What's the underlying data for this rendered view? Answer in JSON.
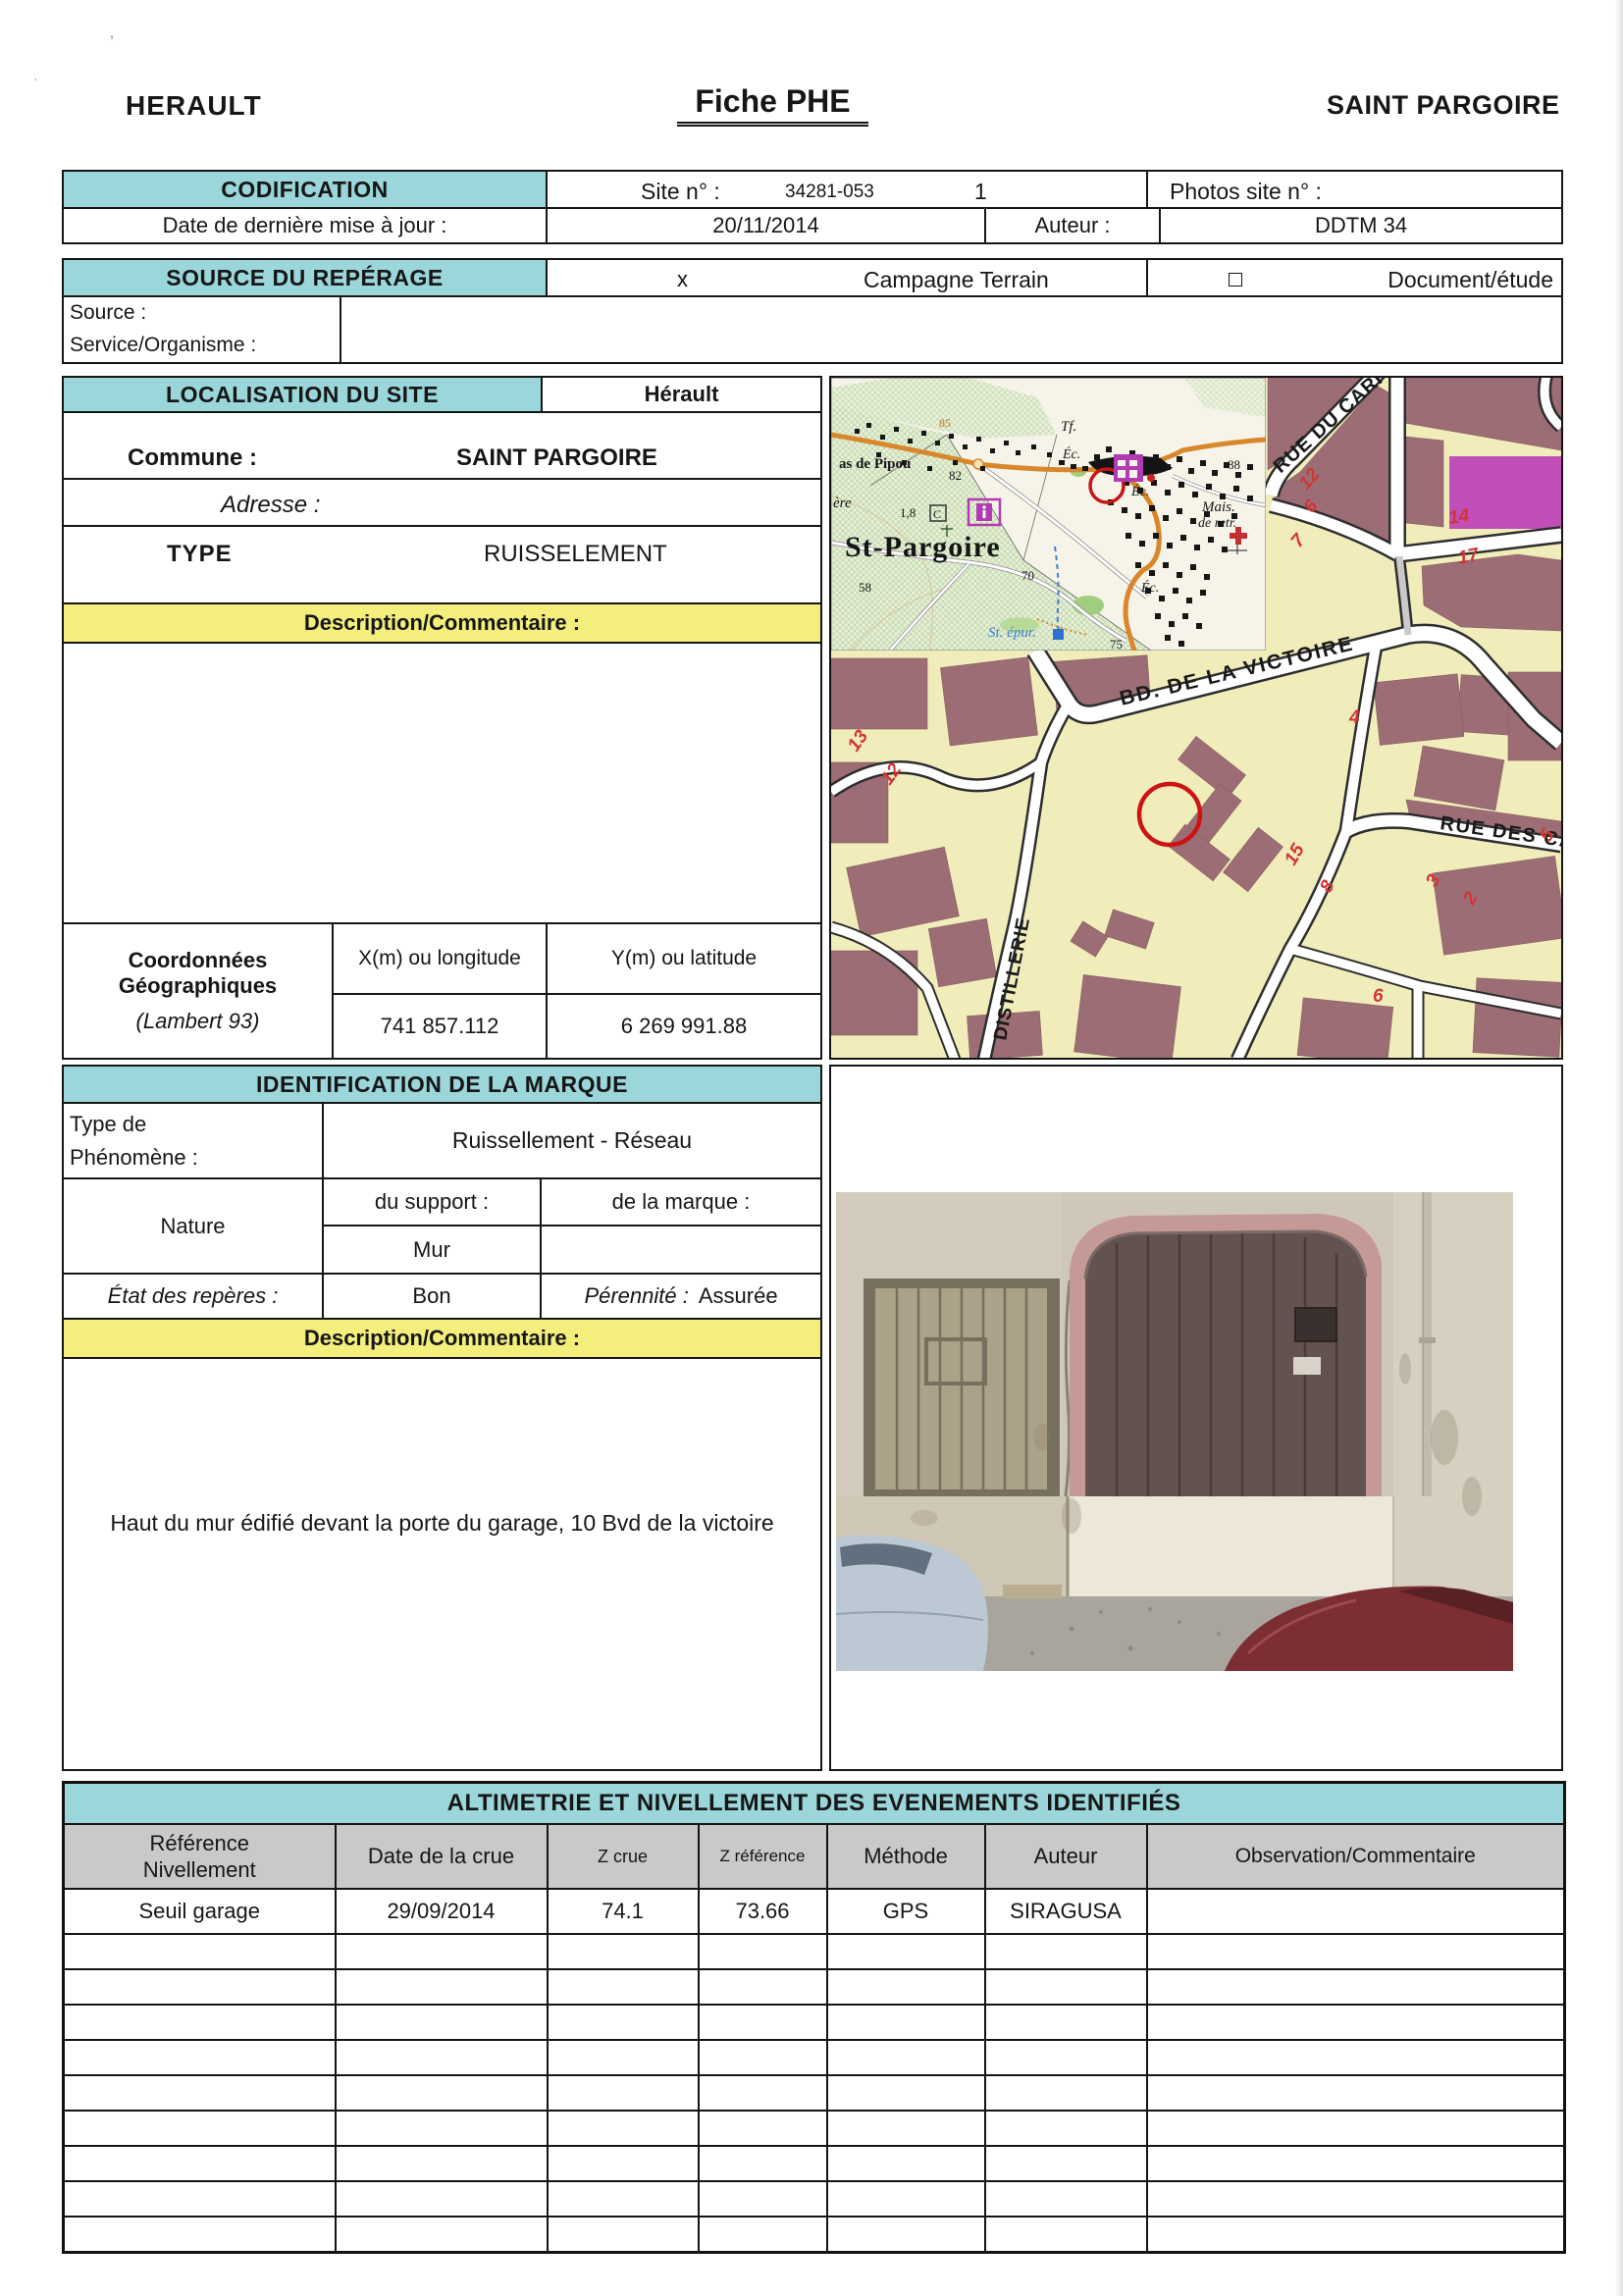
{
  "header": {
    "left": "HERAULT",
    "center": "Fiche PHE",
    "right": "SAINT PARGOIRE"
  },
  "codification": {
    "title": "CODIFICATION",
    "site_label": "Site n° :",
    "site_value": "34281-053",
    "site_index": "1",
    "photos_label": "Photos site n° :",
    "date_label": "Date de dernière mise à jour :",
    "date_value": "20/11/2014",
    "auteur_label": "Auteur :",
    "auteur_value": "DDTM 34"
  },
  "source": {
    "title": "SOURCE DU REPÉRAGE",
    "campagne_mark": "x",
    "campagne_label": "Campagne Terrain",
    "document_label": "Document/étude",
    "source_label": "Source :",
    "service_label": "Service/Organisme :"
  },
  "localisation": {
    "title": "LOCALISATION DU SITE",
    "departement": "Hérault",
    "commune_label": "Commune :",
    "commune_value": "SAINT PARGOIRE",
    "adresse_label": "Adresse :",
    "type_label": "TYPE",
    "type_value": "RUISSELEMENT",
    "description_label": "Description/Commentaire :",
    "coords": {
      "line1": "Coordonnées",
      "line2": "Géographiques",
      "subtitle": "(Lambert 93)",
      "x_label": "X(m) ou longitude",
      "y_label": "Y(m) ou latitude",
      "x_value": "741 857.112",
      "y_value": "6 269 991.88"
    }
  },
  "identification": {
    "title": "IDENTIFICATION DE LA MARQUE",
    "phenomene_label1": "Type de",
    "phenomene_label2": "Phénomène :",
    "phenomene_value": "Ruissellement - Réseau",
    "nature_label": "Nature",
    "support_label": "du support :",
    "marque_label": "de la marque :",
    "support_value": "Mur",
    "etat_label": "État des repères :",
    "etat_value": "Bon",
    "perennite_label": "Pérennité :",
    "perennite_value": "Assurée",
    "description_label": "Description/Commentaire :",
    "description_value": "Haut du mur édifié devant la porte du garage, 10 Bvd de la victoire"
  },
  "altimetrie": {
    "title": "ALTIMETRIE ET NIVELLEMENT DES EVENEMENTS IDENTIFIÉS",
    "columns": [
      "Référence\nNivellement",
      "Date de la crue",
      "Z crue",
      "Z référence",
      "Méthode",
      "Auteur",
      "Observation/Commentaire"
    ],
    "row": [
      "Seuil garage",
      "29/09/2014",
      "74.1",
      "73.66",
      "GPS",
      "SIRAGUSA"
    ]
  },
  "map": {
    "inset": {
      "town": "St-Pargoire",
      "pipou": "as de Pipou",
      "ere": "ère",
      "tf": "Tf.",
      "ec": "Éc.",
      "mais": "Mais.",
      "retr": "de retr.",
      "epur": "St. épur.",
      "n85": "85",
      "n82": "82",
      "n88": "88",
      "n70": "70",
      "n58": "58",
      "n75": "75",
      "n18": "1,8",
      "c": "C"
    },
    "streets": {
      "carri": "RUE DU CARRI",
      "victoire": "BD. DE LA VICTOIRE",
      "des_ca": "RUE DES CA",
      "distillerie": "DISTILLERIE"
    },
    "numbers": {
      "n12a": "12",
      "n6a": "6",
      "n7": "7",
      "n14": "14",
      "n17": "17",
      "n4": "4",
      "n13": "13",
      "n12b": "12",
      "n15": "15",
      "n8": "8",
      "n3": "3",
      "n2": "2",
      "n6b": "6",
      "n5": "5"
    }
  },
  "colors": {
    "teal": "#9bd6da",
    "yellow": "#f4ee7d",
    "header_gray": "#c9c9cb",
    "map_bg": "#f0edbb",
    "map_building": "#9c6d74",
    "map_magenta": "#c050b8",
    "marker_red": "#cc1414"
  }
}
